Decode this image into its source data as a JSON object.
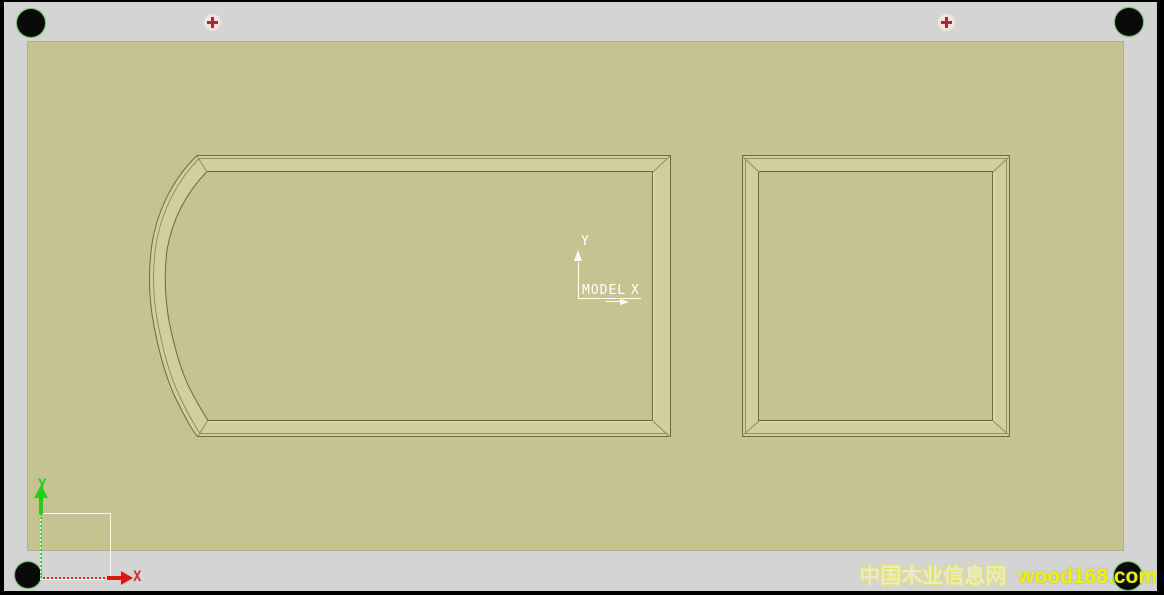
{
  "colors": {
    "page-border": "#000000",
    "workspace-gray": "#d4d4d4",
    "sheet-khaki": "#c6c391",
    "frame-band": "#d1cf9e",
    "frame-line-dark": "#6a6942",
    "frame-line-mid": "#8f8e60",
    "frame-line-light": "#e4e2b6",
    "axis-white": "#ffffff",
    "origin-green": "#22cc22",
    "origin-red": "#dd1515",
    "origin-red-label": "#cc3333",
    "marker-red": "#a82838",
    "marker-bg": "#eee6de",
    "dot-black": "#0a0a0a",
    "watermark-name": "#e7e9da",
    "watermark-domain": "#eff203"
  },
  "model_axis": {
    "label": "MODEL",
    "x_label": "X",
    "y_label": "Y"
  },
  "origin_axis": {
    "x_label": "X",
    "y_label": "Y"
  },
  "watermark": {
    "site_name": "中国木业信息网",
    "domain": "wood168.com"
  }
}
